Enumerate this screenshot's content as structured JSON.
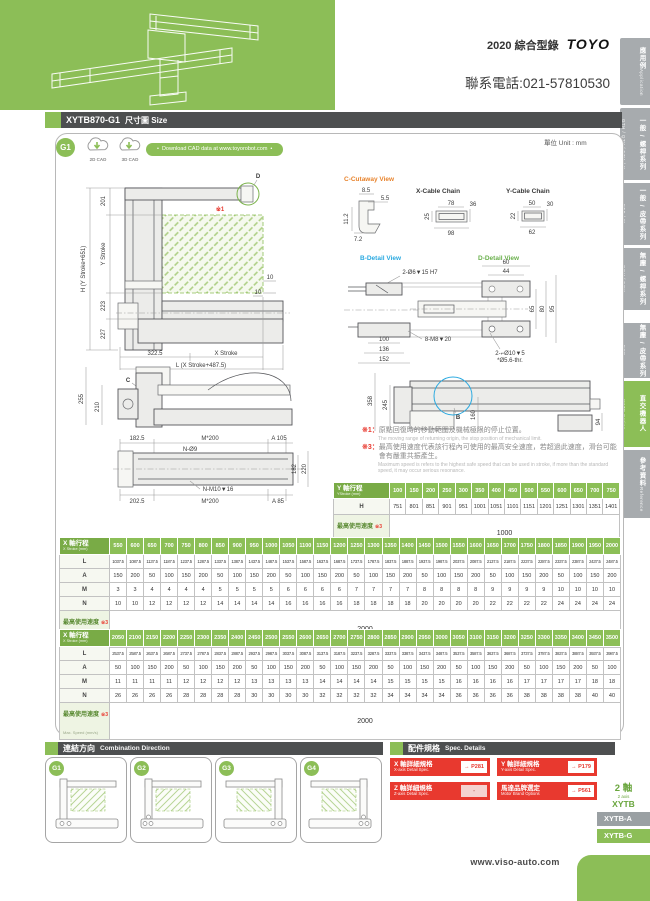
{
  "header": {
    "catalog": "2020 綜合型錄",
    "brand": "TOYO",
    "phone": "聯系電話:021-57810530"
  },
  "sidebar": {
    "tabs": [
      {
        "zh": "應用例",
        "en": "Application"
      },
      {
        "zh": "一般 / 螺桿系列",
        "en": "GTH / QTY / ETH / Y"
      },
      {
        "zh": "一般 / 皮帶系列",
        "en": "ETB / M"
      },
      {
        "zh": "無塵 / 螺桿系列",
        "en": "GCH / ECH"
      },
      {
        "zh": "無塵 / 皮帶系列",
        "en": "ECB"
      },
      {
        "zh": "直交機器人",
        "en": "XYTB Series"
      },
      {
        "zh": "參考資料",
        "en": "Reference"
      }
    ]
  },
  "title_bar": {
    "model": "XYTB870-G1",
    "label": "尺寸圖 Size"
  },
  "cad": {
    "badge": "G1",
    "cad2d": "2D CAD",
    "cad3d": "3D CAD",
    "download": "Download CAD data at www.toyorobot.com",
    "unit": "單位 Unit : mm"
  },
  "drawing": {
    "front": {
      "d": "D",
      "note": "※1",
      "h_total": "H (Y Stroke+651)",
      "seg201": "201",
      "y_stroke": "Y Stroke",
      "seg223": "223",
      "seg227": "227",
      "off10a": "10",
      "off10b": "10",
      "base": "322.5",
      "x_stroke": "X Stroke",
      "l_total": "L (X Stroke+487.5)"
    },
    "cutaway": {
      "title": "C-Cutaway View",
      "d1": "8.5",
      "d2": "5.5",
      "d3": "11.2",
      "d4": "7.2"
    },
    "x_chain": {
      "title": "X-Cable Chain",
      "w": "78",
      "h": "36",
      "inner": "25",
      "outer": "98"
    },
    "y_chain": {
      "title": "Y-Cable Chain",
      "w": "50",
      "h": "30",
      "inner": "22",
      "outer": "62"
    },
    "b_detail": {
      "title": "B-Detail View",
      "c1": "2-Ø6▼15 H7",
      "c2": "8-M8▼20",
      "d1": "156",
      "d2": "169",
      "d3": "100",
      "d4": "136",
      "d5": "152"
    },
    "d_detail": {
      "title": "D-Detail View",
      "d1": "60",
      "d2": "44",
      "d3": "65",
      "d4": "80",
      "d5": "95",
      "c1": "2-⌐Ø10▼5",
      "c2": "*Ø5.6-thr."
    },
    "side_left": {
      "c": "C",
      "d1": "255",
      "d2": "210"
    },
    "side_right": {
      "b": "B",
      "d1": "358",
      "d2": "245",
      "d3": "160",
      "d4": "94"
    },
    "plan": {
      "d1": "182.5",
      "d2": "M*200",
      "d3": "A 105",
      "c1": "N-Ø9",
      "d4": "182",
      "d5": "220",
      "c2": "N-M10▼16",
      "d6": "202.5",
      "d7": "M*200",
      "d8": "A 85"
    }
  },
  "notes": {
    "n1_ref": "※1：",
    "n1_zh": "原點回復時的移動範圍及機械極限的停止位置。",
    "n1_en": "The moving range of returning origin, the stop position of mechanical limit.",
    "n3_ref": "※3：",
    "n3_zh": "最高使用速度代表該行程內可使用的最高安全速度，若超過此速度，滑台可能會有嚴重共振產生。",
    "n3_en": "Maximum speed is refers to the highest safe speed that can be used in stroke, if more than the standard speed, it may occur serious resonance."
  },
  "y_table": {
    "header_zh": "Y 軸行程",
    "header_en": "YStroke (mm)",
    "row_label": "H",
    "strokes": [
      "100",
      "150",
      "200",
      "250",
      "300",
      "350",
      "400",
      "450",
      "500",
      "550",
      "600",
      "650",
      "700",
      "750"
    ],
    "h_values": [
      "751",
      "801",
      "851",
      "901",
      "951",
      "1001",
      "1051",
      "1101",
      "1151",
      "1201",
      "1251",
      "1301",
      "1351",
      "1401"
    ],
    "speed": {
      "zh": "最高使用速度",
      "ref": "※3",
      "en": "Max. Speed (mm/s)",
      "value": "1000"
    }
  },
  "x_table_1": {
    "header_zh": "X 軸行程",
    "header_en": "X Stroke (mm)",
    "labels": [
      "L",
      "A",
      "M",
      "N"
    ],
    "strokes": [
      "550",
      "600",
      "650",
      "700",
      "750",
      "800",
      "850",
      "900",
      "950",
      "1000",
      "1050",
      "1100",
      "1150",
      "1200",
      "1250",
      "1300",
      "1350",
      "1400",
      "1450",
      "1500",
      "1550",
      "1600",
      "1650",
      "1700",
      "1750",
      "1800",
      "1850",
      "1900",
      "1950",
      "2000"
    ],
    "L": [
      "1037.5",
      "1087.5",
      "1137.5",
      "1187.5",
      "1237.5",
      "1287.5",
      "1337.5",
      "1387.5",
      "1437.5",
      "1487.5",
      "1537.5",
      "1587.5",
      "1637.5",
      "1687.5",
      "1737.5",
      "1787.5",
      "1837.5",
      "1887.5",
      "1937.5",
      "1987.5",
      "2037.5",
      "2087.5",
      "2137.5",
      "2187.5",
      "2237.5",
      "2287.5",
      "2337.5",
      "2387.5",
      "2437.5",
      "2487.5"
    ],
    "A": [
      "150",
      "200",
      "50",
      "100",
      "150",
      "200",
      "50",
      "100",
      "150",
      "200",
      "50",
      "100",
      "150",
      "200",
      "50",
      "100",
      "150",
      "200",
      "50",
      "100",
      "150",
      "200",
      "50",
      "100",
      "150",
      "200",
      "50",
      "100",
      "150",
      "200"
    ],
    "M": [
      "3",
      "3",
      "4",
      "4",
      "4",
      "4",
      "5",
      "5",
      "5",
      "5",
      "6",
      "6",
      "6",
      "6",
      "7",
      "7",
      "7",
      "7",
      "8",
      "8",
      "8",
      "8",
      "9",
      "9",
      "9",
      "9",
      "10",
      "10",
      "10",
      "10"
    ],
    "N": [
      "10",
      "10",
      "12",
      "12",
      "12",
      "12",
      "14",
      "14",
      "14",
      "14",
      "16",
      "16",
      "16",
      "16",
      "18",
      "18",
      "18",
      "18",
      "20",
      "20",
      "20",
      "20",
      "22",
      "22",
      "22",
      "22",
      "24",
      "24",
      "24",
      "24"
    ],
    "speed": {
      "zh": "最高使用速度",
      "ref": "※3",
      "en": "Max. Speed (mm/s)",
      "value": "2000"
    }
  },
  "x_table_2": {
    "header_zh": "X 軸行程",
    "header_en": "X Stroke (mm)",
    "labels": [
      "L",
      "A",
      "M",
      "N"
    ],
    "strokes": [
      "2050",
      "2100",
      "2150",
      "2200",
      "2250",
      "2300",
      "2350",
      "2400",
      "2450",
      "2500",
      "2550",
      "2600",
      "2650",
      "2700",
      "2750",
      "2800",
      "2850",
      "2900",
      "2950",
      "3000",
      "3050",
      "3100",
      "3150",
      "3200",
      "3250",
      "3300",
      "3350",
      "3400",
      "3450",
      "3500"
    ],
    "L": [
      "2537.5",
      "2587.5",
      "2637.5",
      "2687.5",
      "2737.5",
      "2787.5",
      "2837.5",
      "2887.5",
      "2937.5",
      "2987.5",
      "3037.5",
      "3087.5",
      "3137.5",
      "3187.5",
      "3237.5",
      "3287.5",
      "3337.5",
      "3387.5",
      "3437.5",
      "3487.5",
      "3537.5",
      "3587.5",
      "3637.5",
      "3687.5",
      "3737.5",
      "3787.5",
      "3837.5",
      "3887.5",
      "3937.5",
      "3987.5"
    ],
    "A": [
      "50",
      "100",
      "150",
      "200",
      "50",
      "100",
      "150",
      "200",
      "50",
      "100",
      "150",
      "200",
      "50",
      "100",
      "150",
      "200",
      "50",
      "100",
      "150",
      "200",
      "50",
      "100",
      "150",
      "200",
      "50",
      "100",
      "150",
      "200",
      "50",
      "100"
    ],
    "M": [
      "11",
      "11",
      "11",
      "11",
      "12",
      "12",
      "12",
      "12",
      "13",
      "13",
      "13",
      "13",
      "14",
      "14",
      "14",
      "14",
      "15",
      "15",
      "15",
      "15",
      "16",
      "16",
      "16",
      "16",
      "17",
      "17",
      "17",
      "17",
      "18",
      "18"
    ],
    "N": [
      "26",
      "26",
      "26",
      "26",
      "28",
      "28",
      "28",
      "28",
      "30",
      "30",
      "30",
      "30",
      "32",
      "32",
      "32",
      "32",
      "34",
      "34",
      "34",
      "34",
      "36",
      "36",
      "36",
      "36",
      "38",
      "38",
      "38",
      "38",
      "40",
      "40"
    ],
    "speed": {
      "zh": "最高使用速度",
      "ref": "※3",
      "en": "Max. Speed (mm/s)",
      "value": "2000"
    }
  },
  "combination": {
    "title_zh": "連結方向",
    "title_en": "Combination Direction",
    "items": [
      {
        "label": "G1"
      },
      {
        "label": "G2"
      },
      {
        "label": "G3"
      },
      {
        "label": "G4"
      }
    ]
  },
  "spec": {
    "title_zh": "配件規格",
    "title_en": "Spec. Details",
    "buttons": [
      {
        "zh": "X 軸詳細規格",
        "en": "X-axis Detail Spec.",
        "ref": "→ P281"
      },
      {
        "zh": "Y 軸詳細規格",
        "en": "Y-axis Detail Spec.",
        "ref": "→ P179"
      },
      {
        "zh": "Z 軸詳細規格",
        "en": "Z-axis Detail Spec.",
        "ref": "-"
      },
      {
        "zh": "馬達品牌選定",
        "en": "Motor Brand Options",
        "ref": "→ P561"
      }
    ]
  },
  "series": {
    "axes_zh": "2 軸",
    "axes_en": "2 axis",
    "name": "XYTB",
    "tabs": [
      "XYTB-A",
      "XYTB-G"
    ]
  },
  "footer": {
    "url": "www.viso-auto.com"
  }
}
